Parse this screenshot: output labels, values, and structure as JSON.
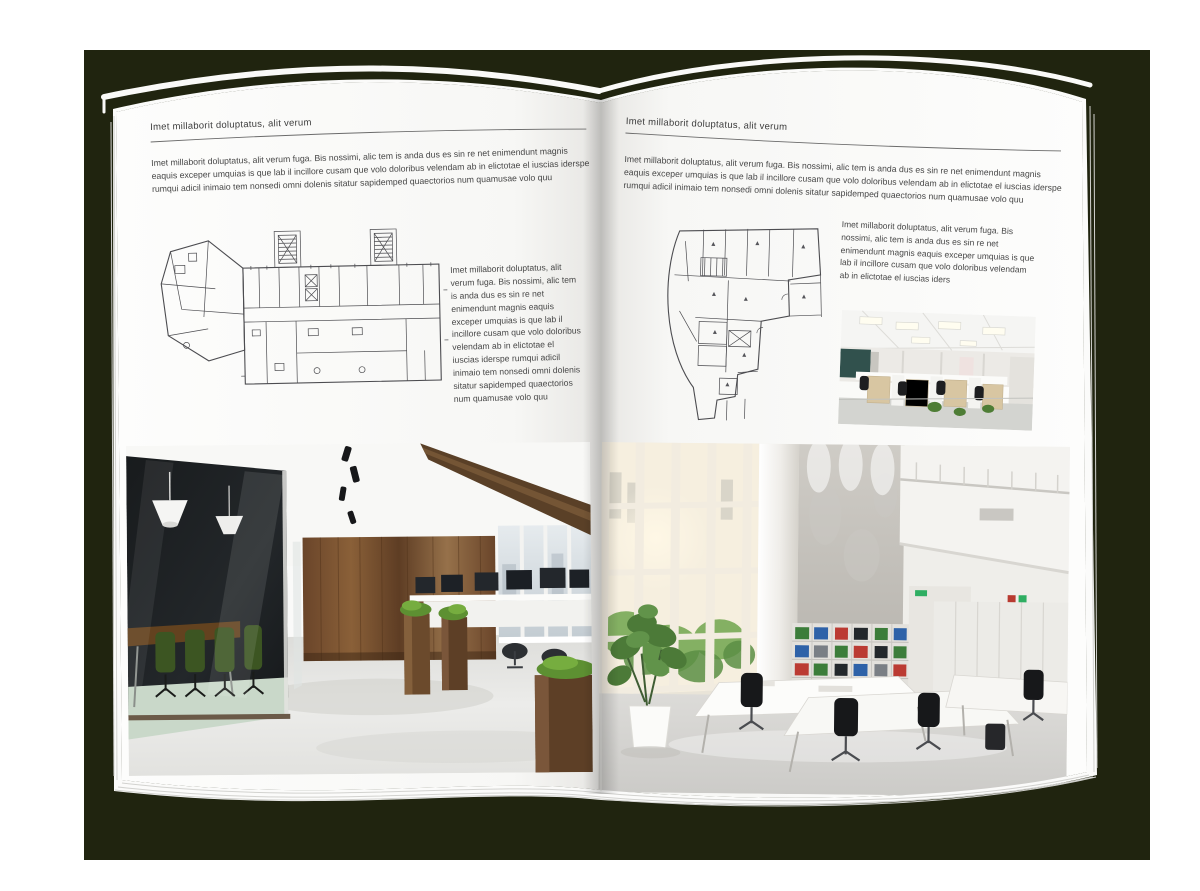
{
  "scene": {
    "backdrop_color": "#20240f",
    "page_color": "#fdfdfc",
    "accent_wood": "#7c5435",
    "accent_green": "#4c7a38"
  },
  "left_page": {
    "header": "Imet millaborit doluptatus, alit verum",
    "intro": "Imet millaborit doluptatus, alit verum fuga. Bis nossimi, alic tem is anda dus es sin re net enimendunt magnis eaquis exceper umquias is que lab il incillore cusam que volo doloribus velendam ab in elictotae el iuscias iderspe rumqui adicil inimaio tem nonsedi omni dolenis sitatur sapidemped quaectorios num quamusae volo quu",
    "side_text": "Imet millaborit doluptatus, alit verum fuga. Bis nossimi, alic tem is anda dus es sin re net enimendunt magnis eaquis exceper umquias is que lab il incillore cusam que volo doloribus velendam ab in elictotae el iuscias iderspe rumqui adicil inimaio tem nonsedi omni dolenis sitatur sapidemped quaectorios num quamusae volo quu"
  },
  "right_page": {
    "header": "Imet millaborit doluptatus, alit verum",
    "intro": "Imet millaborit doluptatus, alit verum fuga. Bis nossimi, alic tem is anda dus es sin re net enimendunt magnis eaquis exceper umquias is que lab il incillore cusam que volo doloribus velendam ab in elictotae el iuscias iderspe rumqui adicil inimaio tem nonsedi omni dolenis sitatur sapidemped quaectorios num quamusae volo quu",
    "side_text": "Imet millaborit doluptatus, alit verum fuga. Bis nossimi, alic tem is anda dus es sin re net enimendunt magnis eaquis exceper umquias is que lab il incillore cusam que volo doloribus velendam ab in elictotae el iuscias iders"
  }
}
